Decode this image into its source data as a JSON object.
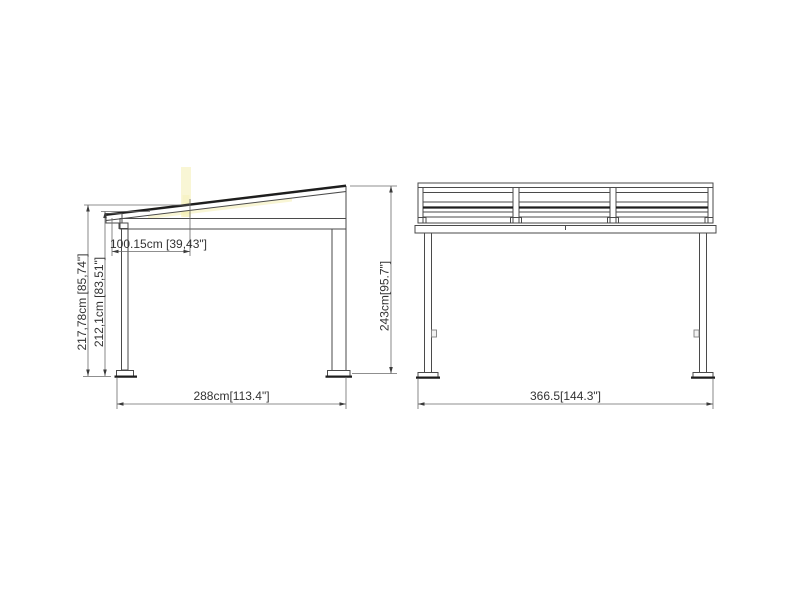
{
  "drawing": {
    "type": "technical-drawing",
    "views": {
      "side": {
        "dims": {
          "overall_height": "217,78cm [85,74\"]",
          "post_height": "212,1cm [83,51\"]",
          "roof_projection": "100.15cm [39,43\"]",
          "base_width": "288cm[113.4\"]",
          "right_height": "243cm[95.7\"]"
        }
      },
      "front": {
        "dims": {
          "base_width": "366.5[144.3\"]"
        }
      }
    },
    "colors": {
      "background": "#ffffff",
      "outline": "#4a4a4a",
      "dim_line": "#6a6a6a",
      "text": "#333333",
      "thick_line": "#1d1d1d",
      "highlight": "#f4eeab"
    }
  }
}
